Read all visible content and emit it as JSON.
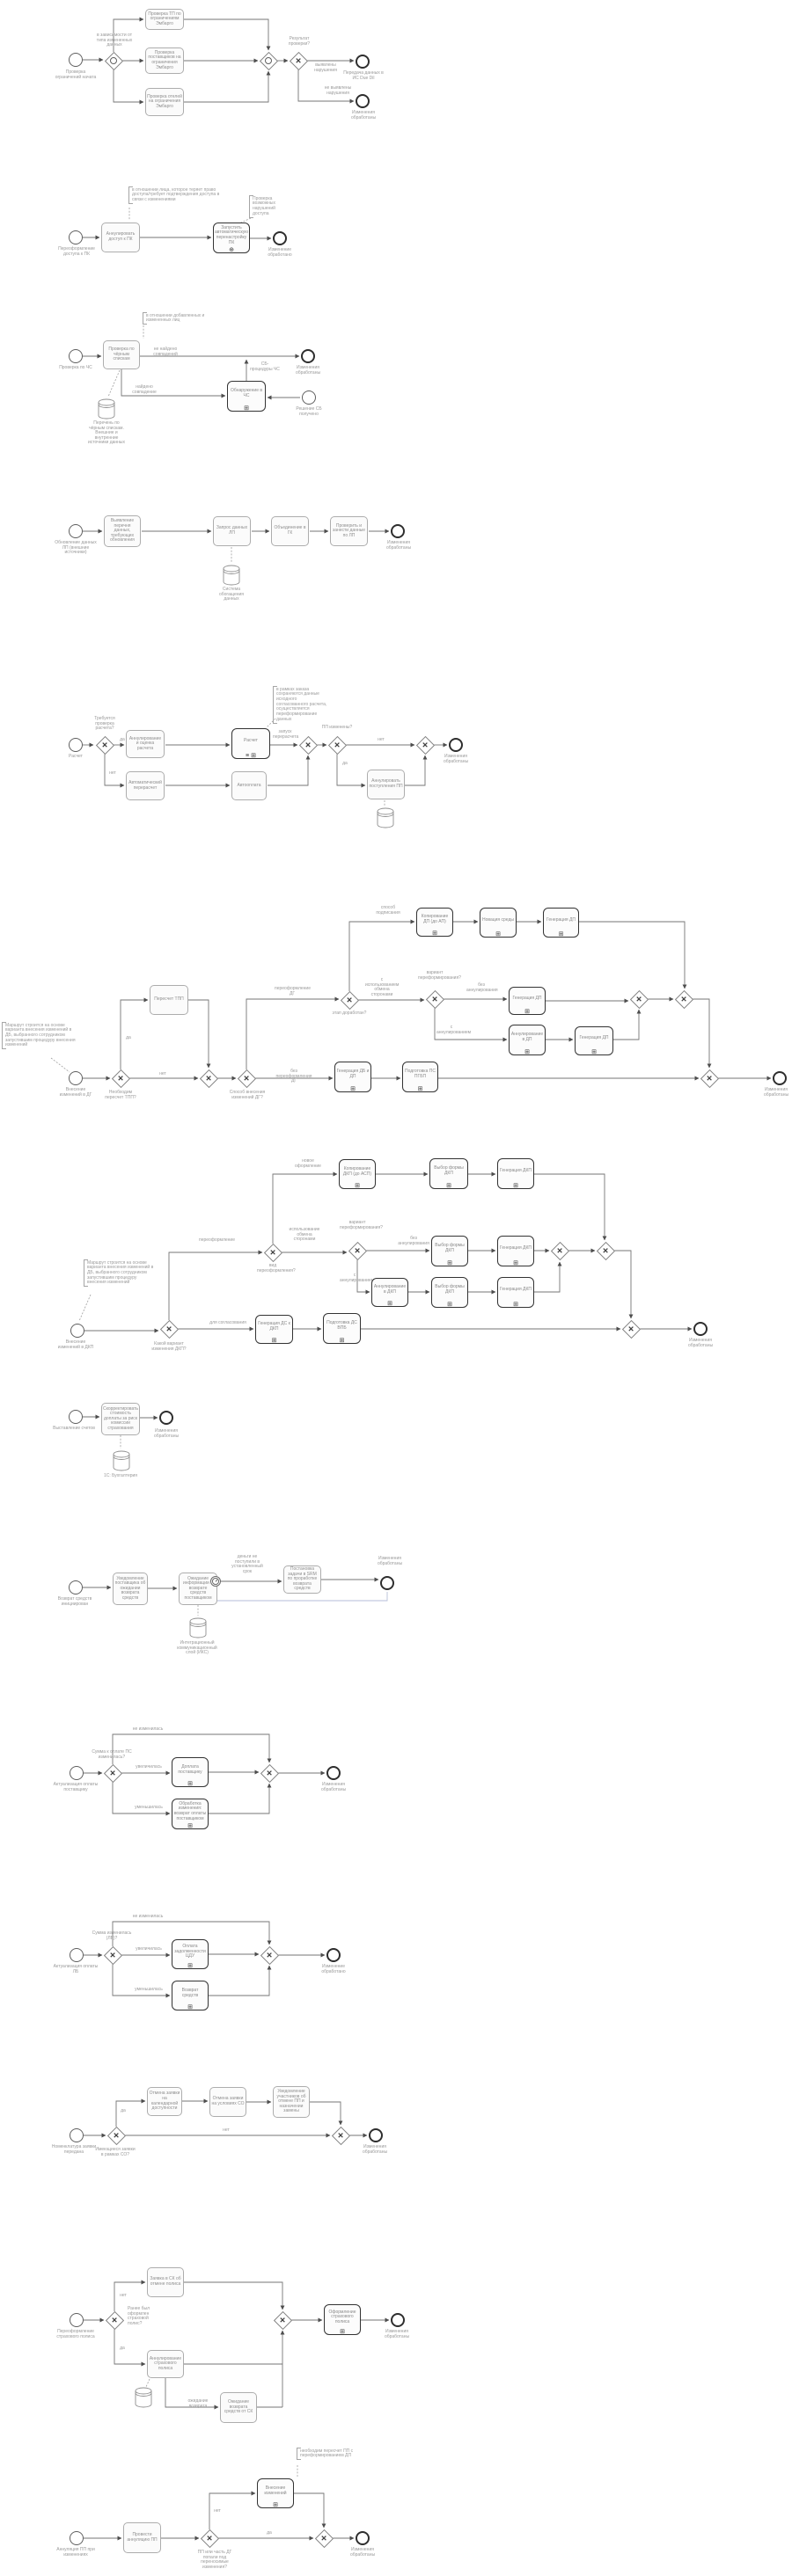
{
  "markers": {
    "x": "✕",
    "sub": "⊞",
    "comp": "⊕",
    "multi_sub": "≡ ⊞"
  },
  "colors": {
    "flow": "#767676",
    "bold_border": "#333333",
    "text": "#8f8f8f",
    "blue_flow": "#b6bed8"
  },
  "d1": {
    "start_lbl": "Проверка ограничений начата",
    "gw1_lbl": "в зависимости от типа измененных данных",
    "t1": "Проверка ТП по ограничениям Эмбарго",
    "t2": "Проверка поставщиков на ограничения Эмбарго",
    "t3": "Проверка отелей на ограничения Эмбарго",
    "gwx_lbl": "Результат проверки?",
    "e1": "выявлены нарушения",
    "e2": "не выявлены нарушения",
    "end1_lbl": "Передача данных в ИС Due Dil",
    "end2_lbl": "Изменения обработаны"
  },
  "d2": {
    "note1": "в отношении лица, которое теряет право доступа/требует подтверждения доступа в связи с изменениями",
    "note2": "Проверка возможных нарушений доступа",
    "start_lbl": "Переоформление доступа к ПК",
    "t1": "Аннулировать доступ к ПК",
    "sp1": "Запустить автоматическую перенастройку ПК",
    "end_lbl": "Изменение обработано"
  },
  "d3": {
    "start_lbl": "Проверка по ЧС",
    "note1": "в отношении добавленных и измененных лиц",
    "t1": "Проверка по чёрным спискам",
    "ds1_lbl": "Перечень по чёрным спискам. Внешние и внутренние источники данных",
    "e1": "не найдено совпадений",
    "e2": "найдено совпадение",
    "e3": "СБ-процедуры ЧС",
    "sp1": "Обнаружение в ЧС",
    "start2_lbl": "Решение СБ получено",
    "end1_lbl": "Изменения обработаны"
  },
  "d4": {
    "start_lbl": "Обновление данных ЛП (внешние источники)",
    "t1": "Выявление перечня данных, требующих обновления",
    "t2": "Запрос данных ЛП",
    "ds1_lbl": "Система обогащения данных",
    "t3": "Объединение в ГК",
    "t4": "Проверить и занести данные по ЛП",
    "end_lbl": "Изменения обработаны"
  },
  "d5": {
    "start_lbl": "Расчет",
    "gw1_lbl": "Требуется проверка расчета?",
    "yes1": "да",
    "no1": "нет",
    "t1": "Аннулирование и оценка расчета",
    "t2": "Автоматический перерасчет",
    "t3": "Автооплата",
    "sp1": "Расчет",
    "note1": "в рамках заказа сохраняются данные исходного согласованного расчета, осуществляется переформирование данных",
    "e1": "запуск перерасчета",
    "gw3_lbl": "ПП изменены?",
    "yes2": "да",
    "no2": "нет",
    "t4": "Аннулировать поступления ПП",
    "end_lbl": "Изменения обработаны"
  },
  "d6": {
    "note1": "Маршрут строится на основе варианта внесения изменений в ДБ, выбранного сотрудником запустившим процедуру внесения изменений",
    "start_lbl": "Внесение изменений в ДГ",
    "gw1_lbl": "Необходим пересчет ТПП?",
    "yes1": "да",
    "no1": "нет",
    "t1": "Пересчет ТПП",
    "gw3_lbl": "Способ внесения изменений ДГ?",
    "e1": "переоформление ДГ",
    "e2": "без переоформления ДГ",
    "gw4_lbl": "этап доработан?",
    "e3": "способ подписания",
    "e4": "с использованием обмена сторонами",
    "sp1": "Копирование ДП (до АП)",
    "sp2": "Новация среды",
    "sp3": "Генерация ДП",
    "gw5_lbl": "вариант переформирования?",
    "e5": "без аннулирования",
    "e6": "с аннулированием",
    "sp4": "Генерация ДП",
    "sp5": "Аннулирование в ДП",
    "sp6": "Генерация ДП",
    "sp7": "Генерация ДБ и ДП",
    "sp8": "Подготовка ПС ПГБП",
    "end_lbl": "Изменения обработаны"
  },
  "d7": {
    "note1": "Маршрут строится на основе варианта внесения изменений в ДБ, выбранного сотрудником запустившим процедуру внесения изменений",
    "start_lbl": "Внесение изменений в ДКП",
    "gw1_lbl": "Какой вариант изменения ДКП?",
    "e1": "переоформление",
    "e2": "для согласования",
    "gw2_lbl": "вид переоформления?",
    "e3": "новое оформление",
    "e4": "использование обмена сторонами",
    "sp1": "Копирование ДКП (до АСП)",
    "gw3_lbl": "вариант переформирования?",
    "e5": "без аннулирования",
    "e6": "с аннулированием",
    "sp2": "Выбор формы ДКП",
    "sp3": "Генерация ДКП",
    "sp4": "Выбор формы ДКП",
    "sp5": "Генерация ДКП",
    "sp6": "Аннулирование в ДКП",
    "sp7": "Выбор формы ДКП",
    "sp8": "Генерация ДКП",
    "sp9": "Генерация ДС к ДКП",
    "sp10": "Подготовка ДС ВПБ",
    "end_lbl": "Изменения обработаны"
  },
  "d8": {
    "start_lbl": "Выставление счетов",
    "t1": "Скорректировать стоимость доплаты за риск комиссии страхования",
    "ds1_lbl": "1С: Бухгалтерия",
    "end_lbl": "Изменения обработаны"
  },
  "d9": {
    "start_lbl": "Возврат средств инициирован",
    "t1": "Уведомление поставщика об ожидании возврата средств",
    "t2": "Ожидание информации о возврате средств поставщиком",
    "ds1_lbl": "Интеграционный коммуникационный слой (ИКС)",
    "e1": "деньги не поступили в установленный срок",
    "t3": "Постановка задачи в SRM по проработке возврата средств",
    "end_lbl": "Изменения обработаны"
  },
  "d10": {
    "start_lbl": "Актуализация оплаты поставщику",
    "gw1_lbl": "Сумма к оплате ПС изменилась?",
    "e1": "не изменилась",
    "e2": "увеличилась",
    "e3": "уменьшилась",
    "sp1": "Доплата поставщику",
    "sp2": "Обработка изменения: возврат оплаты поставщиком",
    "end_lbl": "Изменения обработаны"
  },
  "d11": {
    "start_lbl": "Актуализация оплаты ЛБ",
    "gw1_lbl": "Сумма изменилась (ЛБ)?",
    "e1": "не изменилась",
    "e2": "увеличилась",
    "e3": "уменьшилась",
    "sp1": "Оплата задолженности ЦДУ",
    "sp2": "Возврат средств",
    "end_lbl": "Изменение обработано"
  },
  "d12": {
    "start_lbl": "Номенклатура заявки передана",
    "gw1_lbl": "Имеющиеся заявки в рамках СО?",
    "yes1": "да",
    "no1": "нет",
    "t1": "Отмена заявки на календарной доступности",
    "t2": "Отмена заявки на условиях СО",
    "t3": "Уведомление участников об отмене ПП и назначении замены",
    "end_lbl": "Изменения обработаны"
  },
  "d13": {
    "start_lbl": "Переоформление страхового полиса",
    "gw1_lbl": "Ранее был оформлен страховой полис?",
    "no1": "нет",
    "yes1": "да",
    "e3": "ожидание возврата",
    "t1": "Заявка в СК об отмене полиса",
    "t2": "Аннулирование страхового полиса",
    "t3": "Ожидание возврата средств от СК",
    "sp1": "Оформление страхового полиса",
    "end_lbl": "Изменения обработаны"
  },
  "d14": {
    "start_lbl": "Аннуляция ПП при изменениях",
    "t1": "Провести аннуляцию ПП",
    "gw1_lbl": "ПП или часть ДГ попали под переносимые изменения?",
    "no1": "нет",
    "yes1": "да",
    "note1": "необходим пересчет ПП с переформированием ДП",
    "sp1": "Внесение изменений",
    "end_lbl": "Изменения обработаны"
  }
}
